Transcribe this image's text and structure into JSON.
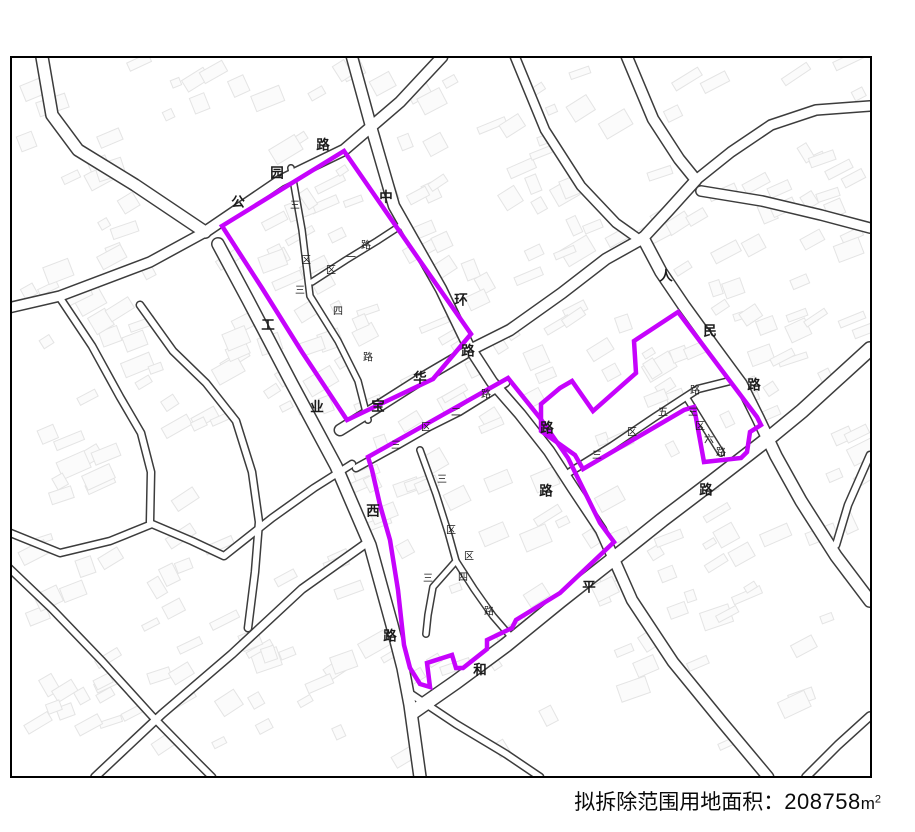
{
  "title": "龙华区龙华街道龙华第三工业区城市更新单元（计划调整） 拟拆除范围示意图",
  "footer": {
    "label": "拟拆除范围用地面积：",
    "value": "208758",
    "unit_m": "m",
    "unit_sup": "2"
  },
  "map": {
    "colors": {
      "background": "#ffffff",
      "border": "#000000",
      "road_casing": "#3c3c3c",
      "road_fill": "#ffffff",
      "building": "#e4e4e4",
      "boundary": "#c603fc",
      "label": "#1a1a1a"
    },
    "frame": {
      "x": 11,
      "y": 57,
      "w": 860,
      "h": 720
    },
    "roads": [
      {
        "name": "north-access-road",
        "width": 14,
        "points": "42,57 52,115 78,150 135,185 205,232"
      },
      {
        "name": "gongyuan-road",
        "width": 13,
        "points": "205,232 280,181 344,150 400,102 442,57"
      },
      {
        "name": "west-border-road",
        "width": 12,
        "points": "205,232 150,262 60,296 8,308"
      },
      {
        "name": "gongye-west-road",
        "width": 14,
        "points": "218,244 248,300 292,384 336,466 370,545 392,625 403,668 410,705 420,777"
      },
      {
        "name": "zhonghuan-road",
        "width": 13,
        "points": "352,57 372,130 394,206 441,289 468,345 492,382 520,414 549,451 573,488 601,530 632,600 673,662 722,722 768,777"
      },
      {
        "name": "baohua-road",
        "width": 13,
        "points": "340,430 382,404 426,376 472,349 510,330 562,293 606,259 640,240"
      },
      {
        "name": "renmin-road-north",
        "width": 13,
        "points": "627,57 653,119 679,159 696,180"
      },
      {
        "name": "renmin-road-link",
        "width": 13,
        "points": "696,180 668,211 643,238"
      },
      {
        "name": "renmin-road",
        "width": 14,
        "points": "643,238 661,272 684,306 713,346 741,384 758,418 776,456 801,501 836,556 870,601"
      },
      {
        "name": "heping-road",
        "width": 16,
        "points": "413,712 456,682 506,645 560,601 612,560 662,520 712,482 747,455 774,434 802,411 836,380 870,349"
      },
      {
        "name": "northeast-road-1",
        "width": 12,
        "points": "696,180 731,152 771,125 816,110 870,106"
      },
      {
        "name": "northeast-road-2",
        "width": 12,
        "points": "701,191 762,201 821,215 870,228"
      },
      {
        "name": "top-middle-road",
        "width": 11,
        "points": "515,57 545,130 581,186 616,223 640,240"
      },
      {
        "name": "sanqu-3-road-north",
        "width": 8,
        "points": "291,168 302,230 310,296 338,341 358,381 368,420"
      },
      {
        "name": "sanqu-1-road",
        "width": 8,
        "points": "312,282 346,260 377,241 400,226"
      },
      {
        "name": "sanqu-2-road",
        "width": 9,
        "points": "356,468 396,446 429,427 459,412 488,394 506,383"
      },
      {
        "name": "sanqu-3-road-south",
        "width": 8,
        "points": "420,450 436,494 448,532 456,561 433,587 428,615 426,634"
      },
      {
        "name": "sanqu-4-road",
        "width": 8,
        "points": "456,561 474,589 493,616 512,638"
      },
      {
        "name": "sanqu-5-road",
        "width": 9,
        "points": "570,472 612,446 655,417 698,389 734,380"
      },
      {
        "name": "sanqu-6-road",
        "width": 8,
        "points": "688,400 706,429 721,453"
      },
      {
        "name": "east-small-road",
        "width": 9,
        "points": "870,455 848,505 836,545"
      },
      {
        "name": "southeast-corner-road",
        "width": 10,
        "points": "806,777 838,745 870,716"
      },
      {
        "name": "left-road-a",
        "width": 9,
        "points": "60,298 92,346 120,397 141,433 151,472 150,522"
      },
      {
        "name": "left-road-b",
        "width": 9,
        "points": "140,305 173,351 206,383 236,421 252,472 259,522 255,572 248,628"
      },
      {
        "name": "left-road-c",
        "width": 9,
        "points": "8,532 60,553 110,541 152,524 192,541 224,556 272,518 314,488 352,464"
      },
      {
        "name": "left-road-d",
        "width": 9,
        "points": "8,567 52,609 102,661 152,716 196,761 212,777"
      },
      {
        "name": "left-road-e",
        "width": 10,
        "points": "95,777 162,714 232,654 302,589 368,542"
      },
      {
        "name": "bottom-middle-road",
        "width": 9,
        "points": "405,690 456,724 506,754 540,777"
      }
    ],
    "boundaries": [
      {
        "name": "demolition-boundary-west",
        "points": "222,226 344,151 418,258 471,334 433,379 347,420 302,352 262,288"
      },
      {
        "name": "demolition-boundary-middle",
        "points": "368,457 508,378 540,418 568,458 600,523 614,542 560,593 516,620 512,628 487,640 487,649 463,668 456,668 452,655 427,663 430,687 420,684 410,668 404,645 398,590 390,540 380,505 372,470"
      },
      {
        "name": "demolition-boundary-east",
        "points": "678,312 757,417 761,425 750,432 747,452 741,458 704,462 694,407 684,410 583,469 575,455 541,431 541,404 560,388 572,381 593,411 636,373 634,341"
      }
    ],
    "labels": [
      {
        "t": "公",
        "x": 238,
        "y": 203
      },
      {
        "t": "园",
        "x": 277,
        "y": 174
      },
      {
        "t": "路",
        "x": 323,
        "y": 146
      },
      {
        "t": "中",
        "x": 386,
        "y": 198
      },
      {
        "t": "环",
        "x": 461,
        "y": 301
      },
      {
        "t": "路",
        "x": 468,
        "y": 352
      },
      {
        "t": "工",
        "x": 268,
        "y": 326
      },
      {
        "t": "业",
        "x": 317,
        "y": 408
      },
      {
        "t": "西",
        "x": 373,
        "y": 512
      },
      {
        "t": "路",
        "x": 390,
        "y": 637
      },
      {
        "t": "宝",
        "x": 378,
        "y": 407
      },
      {
        "t": "华",
        "x": 420,
        "y": 379
      },
      {
        "t": "人",
        "x": 666,
        "y": 277
      },
      {
        "t": "民",
        "x": 710,
        "y": 332
      },
      {
        "t": "路",
        "x": 754,
        "y": 386
      },
      {
        "t": "和",
        "x": 480,
        "y": 671
      },
      {
        "t": "平",
        "x": 589,
        "y": 588
      },
      {
        "t": "路",
        "x": 706,
        "y": 491
      },
      {
        "t": "路",
        "x": 547,
        "y": 429
      },
      {
        "t": "路",
        "x": 546,
        "y": 492
      },
      {
        "t": "三",
        "x": 295,
        "y": 206,
        "s": 1
      },
      {
        "t": "区",
        "x": 306,
        "y": 261,
        "s": 1
      },
      {
        "t": "三",
        "x": 300,
        "y": 291,
        "s": 1
      },
      {
        "t": "四",
        "x": 338,
        "y": 312,
        "s": 1
      },
      {
        "t": "路",
        "x": 368,
        "y": 358,
        "s": 1
      },
      {
        "t": "区",
        "x": 331,
        "y": 271,
        "s": 1
      },
      {
        "t": "一",
        "x": 351,
        "y": 258,
        "s": 1
      },
      {
        "t": "路",
        "x": 366,
        "y": 246,
        "s": 1
      },
      {
        "t": "三",
        "x": 396,
        "y": 446,
        "s": 1
      },
      {
        "t": "区",
        "x": 426,
        "y": 428,
        "s": 1
      },
      {
        "t": "二",
        "x": 456,
        "y": 413,
        "s": 1
      },
      {
        "t": "路",
        "x": 486,
        "y": 395,
        "s": 1
      },
      {
        "t": "三",
        "x": 442,
        "y": 480,
        "s": 1
      },
      {
        "t": "区",
        "x": 451,
        "y": 531,
        "s": 1
      },
      {
        "t": "区",
        "x": 469,
        "y": 557,
        "s": 1
      },
      {
        "t": "三",
        "x": 428,
        "y": 579,
        "s": 1
      },
      {
        "t": "四",
        "x": 463,
        "y": 578,
        "s": 1
      },
      {
        "t": "路",
        "x": 489,
        "y": 612,
        "s": 1
      },
      {
        "t": "三",
        "x": 597,
        "y": 456,
        "s": 1
      },
      {
        "t": "区",
        "x": 632,
        "y": 433,
        "s": 1
      },
      {
        "t": "五",
        "x": 663,
        "y": 413,
        "s": 1
      },
      {
        "t": "路",
        "x": 695,
        "y": 391,
        "s": 1
      },
      {
        "t": "三",
        "x": 693,
        "y": 413,
        "s": 1
      },
      {
        "t": "区",
        "x": 700,
        "y": 427,
        "s": 1
      },
      {
        "t": "六",
        "x": 709,
        "y": 440,
        "s": 1
      },
      {
        "t": "路",
        "x": 721,
        "y": 453,
        "s": 1
      }
    ]
  }
}
